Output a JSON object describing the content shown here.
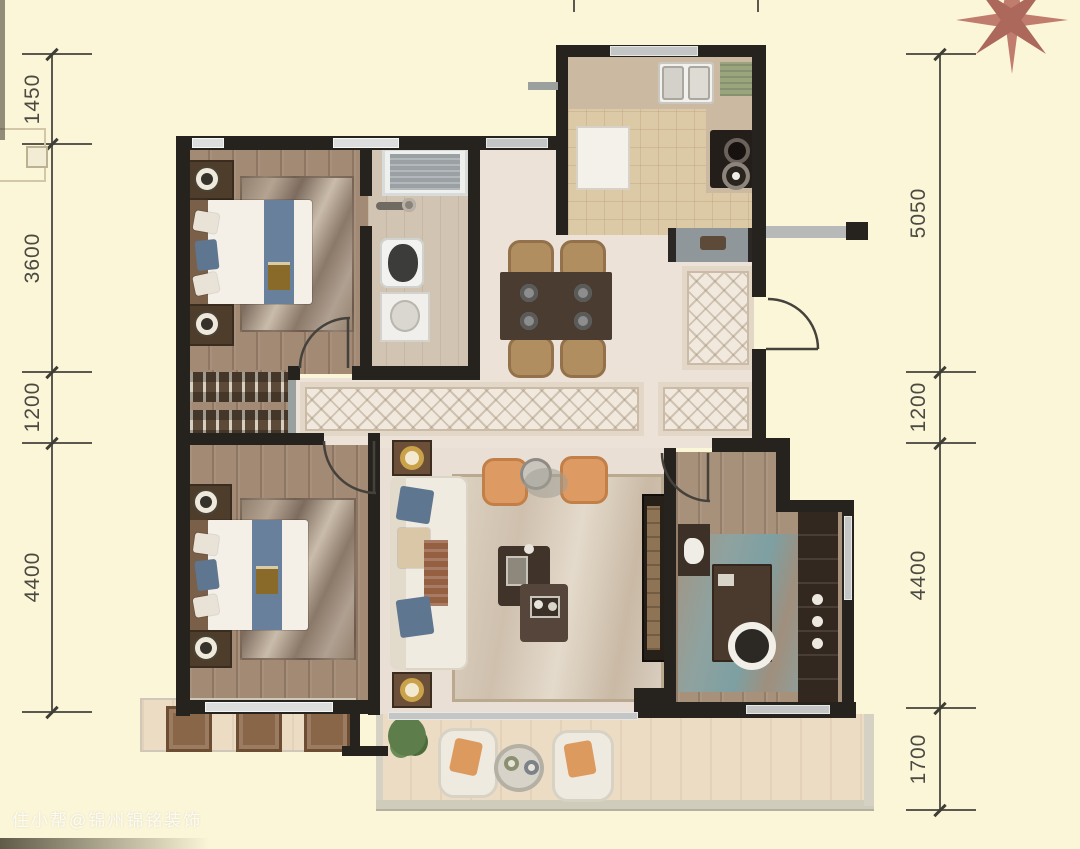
{
  "image": {
    "type": "apartment-floor-plan"
  },
  "dimensions": {
    "left": [
      "1450",
      "3600",
      "1200",
      "4400"
    ],
    "right": [
      "5050",
      "1200",
      "4400",
      "1700"
    ]
  },
  "watermark": "住小帮@锦州锦铭装饰",
  "compass": {
    "name": "compass-rose",
    "color": "#c07d6e",
    "color_dark": "#ab685b"
  },
  "colors": {
    "background": "#fbf6d8",
    "wall": "#26221d",
    "wood_floor": "#a28a75",
    "hall_floor": "#ece2d7",
    "kitchen_tile": "#dcc9a6",
    "balcony_floor": "#ecdcc4",
    "accent_orange": "#dd9a62",
    "accent_blue": "#68809b",
    "dimension_text": "#4b4a42"
  }
}
